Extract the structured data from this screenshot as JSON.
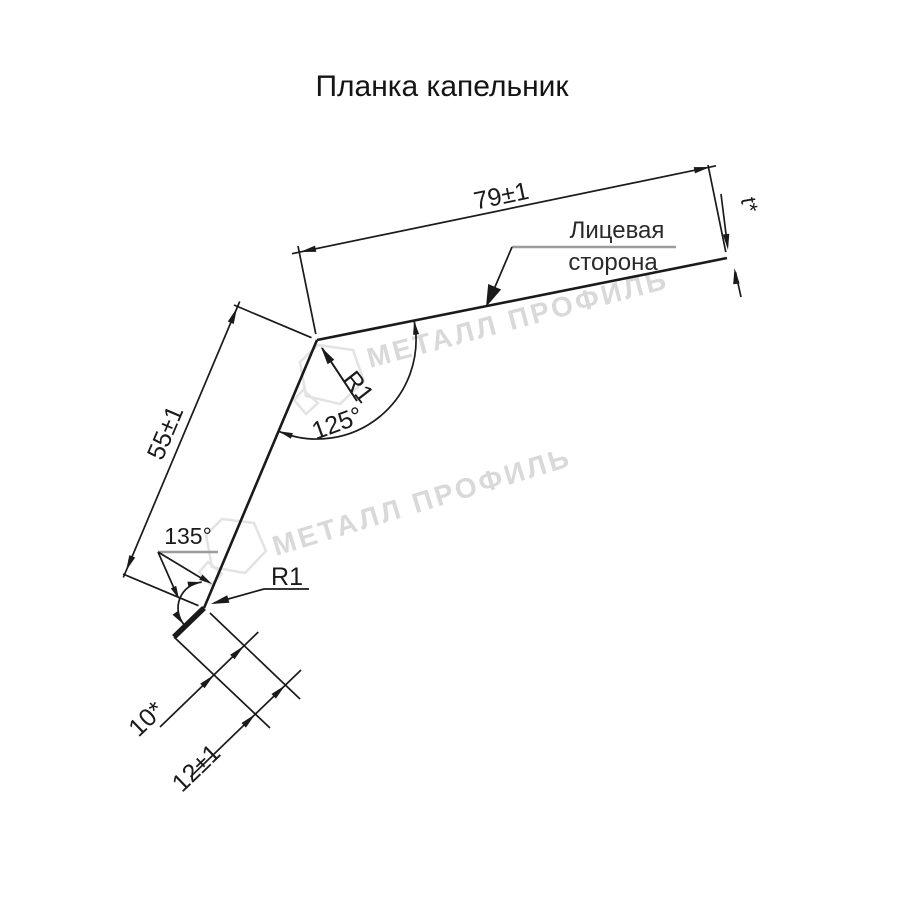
{
  "title": "Планка капельник",
  "watermark": {
    "text": "МЕТАЛЛ ПРОФИЛЬ"
  },
  "labels": {
    "dim_top": "79±1",
    "dim_side": "55±1",
    "dim_hem_inner": "10*",
    "dim_hem_outer": "12±1",
    "dim_thickness": "t*",
    "angle_top": "125°",
    "angle_bottom": "135°",
    "radius_top": "R1",
    "radius_bottom": "R1",
    "face_line1": "Лицевая",
    "face_line2": "сторона"
  },
  "colors": {
    "line": "#1a1a1a",
    "watermark": "#d9d9d9",
    "hexagon_outline": "#e3e3e3",
    "leader_underline": "#9c9c9c",
    "background": "#ffffff"
  }
}
